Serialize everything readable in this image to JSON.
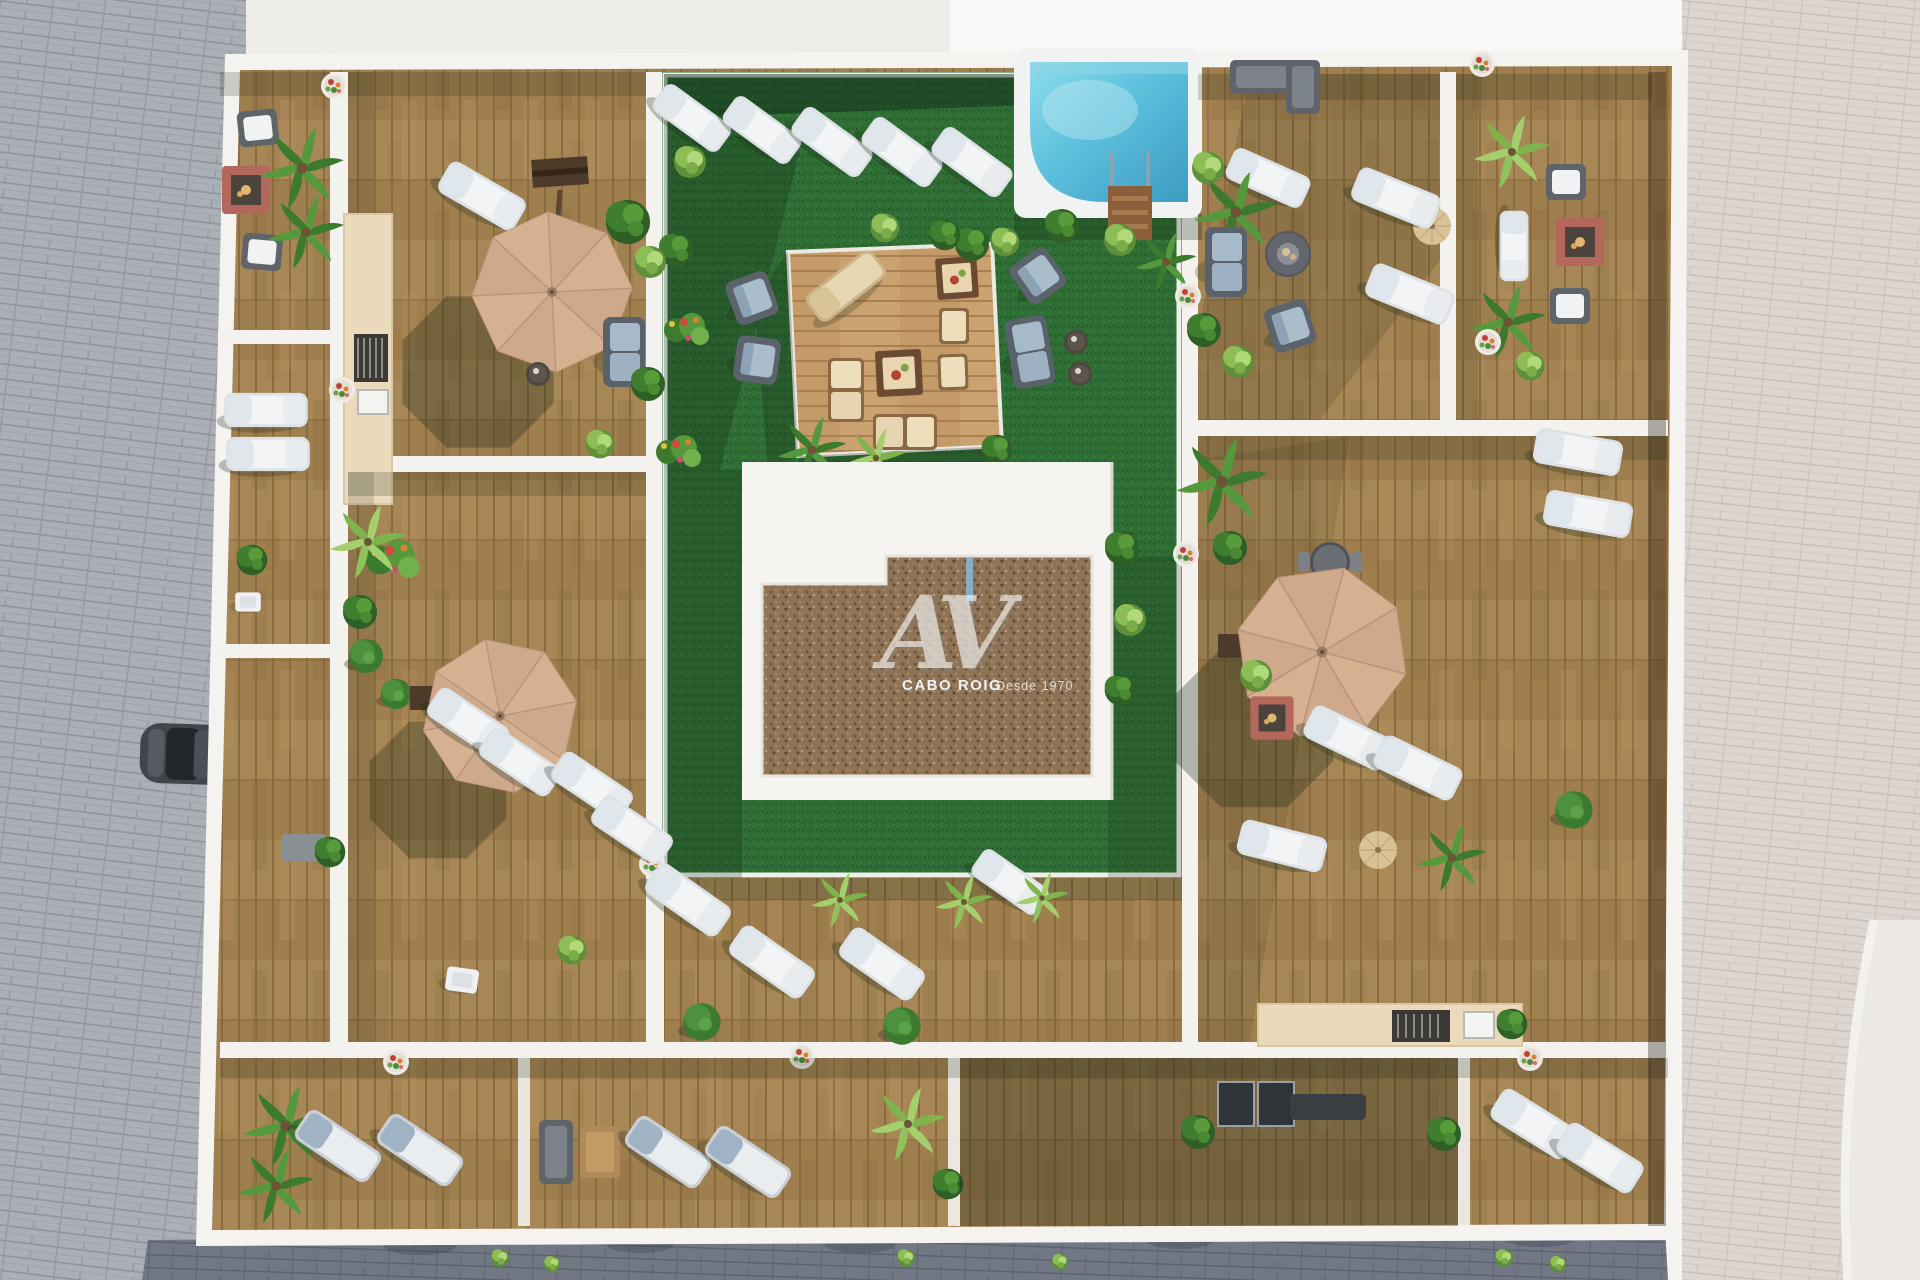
{
  "scene": {
    "alt": "Aerial top-down 3D architectural render of a rooftop terrace complex: central green courtyard with swimming pool, wooden pergola deck, gravel-roofed core building, perimeter wooden terraces with sun loungers, parasols, sofas and plants, surrounded by paved streets with a parked car"
  },
  "watermark": {
    "monogram": "AV",
    "brand": "CABO ROIG",
    "tagline": "Desde 1970"
  },
  "palette": {
    "street_left": "#abb0b6",
    "street_right": "#ddd6d0",
    "street_bottom": "#717883",
    "sidewalk": "#ece9e5",
    "wall_white": "#f4f3ef",
    "deck_wood": "#a07f4f",
    "deck_wood_light": "#c49a68",
    "turf_green": "#2f6e35",
    "pool_water": "#5cc0dc",
    "pool_coping": "#f1f3f2",
    "gravel_roof": "#8f7356",
    "umbrella_tan": "#cea98b",
    "lounger_white": "#f2f4f6",
    "cushion_blue": "#a6bac9",
    "counter_cream": "#ead9ba",
    "fire_table_red": "#b4685b",
    "plant_green": "#3f7d2f",
    "plant_lime": "#8dbd55",
    "car_gray": "#41464c",
    "watermark_white": "#ffffff"
  }
}
